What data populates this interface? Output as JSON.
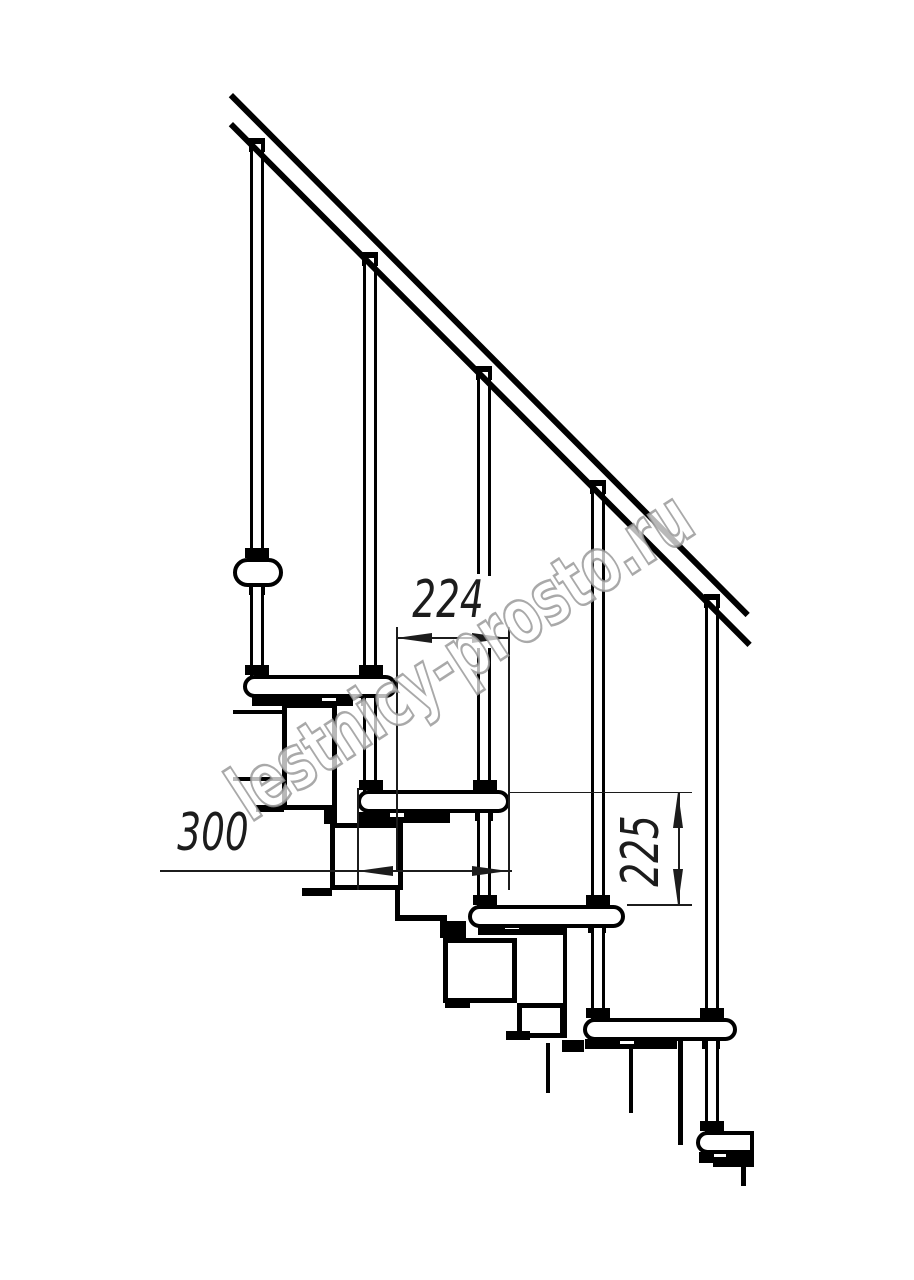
{
  "watermark": {
    "text": "lestnicy-prosto.ru",
    "color": "#989898"
  },
  "dimensions": {
    "step_going": {
      "value": "224"
    },
    "tread_length": {
      "value": "300"
    },
    "step_rise": {
      "value": "225"
    }
  },
  "colors": {
    "background": "#ffffff",
    "drawing_line": "#000000",
    "dimension_line": "#1c1c1c",
    "watermark_gray": "#989898"
  }
}
